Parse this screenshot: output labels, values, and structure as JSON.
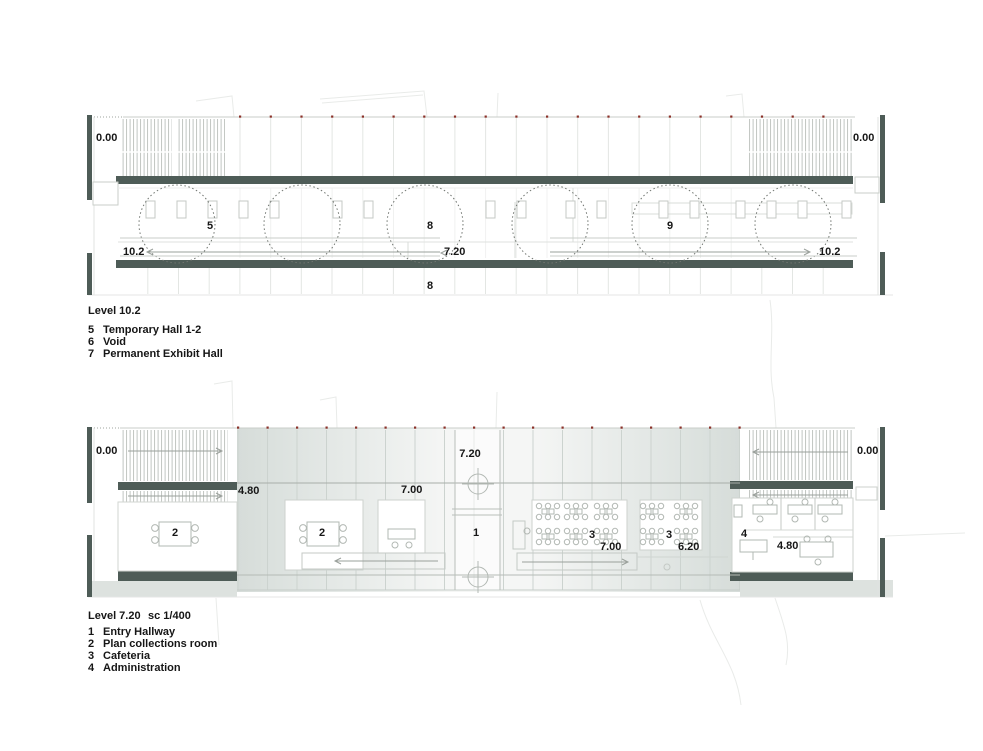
{
  "colors": {
    "wall_dark": "#4e5c57",
    "red_dot": "#8a3028",
    "hatch": "#b9beba",
    "grid_white": "#e3e6e3",
    "grid_faint": "#f0f1f0",
    "grid_tint": "#ccd3cf",
    "outline": "#c9cec9",
    "furniture": "#b2b8b3",
    "dash_circle": "#6f746f",
    "site_line": "#e9ebe9",
    "tint_edge": "#d6dcd9",
    "tint_center": "#f5f6f5",
    "arrow": "#9aa09b",
    "text": "#161616"
  },
  "upper_plan": {
    "elev_site_left": "0.00",
    "elev_site_right": "0.00",
    "room_temporary": "5",
    "room_exhibit_mid": "8",
    "room_exhibit_right": "9",
    "elev_hall_left": "10.2",
    "elev_hall_mid": "7.20",
    "elev_hall_right": "10.2",
    "label_below_hall": "8",
    "legend": {
      "title": "Level 10.2",
      "items": [
        {
          "num": "5",
          "name": "Temporary Hall 1-2"
        },
        {
          "num": "6",
          "name": "Void"
        },
        {
          "num": "7",
          "name": "Permanent Exhibit Hall"
        }
      ]
    }
  },
  "lower_plan": {
    "elev_site_left": "0.00",
    "elev_site_right": "0.00",
    "elev_entry": "7.20",
    "elev_left_stair": "4.80",
    "elev_plan_room": "7.00",
    "elev_cafeteria": "7.00",
    "elev_cafeteria2": "6.20",
    "elev_admin": "4.80",
    "room_entry": "1",
    "room_plan_left": "2",
    "room_plan_mid": "2",
    "room_cafeteria_1": "3",
    "room_cafeteria_2": "3",
    "room_admin": "4",
    "legend": {
      "title": "Level 7.20",
      "scale": "sc 1/400",
      "items": [
        {
          "num": "1",
          "name": "Entry Hallway"
        },
        {
          "num": "2",
          "name": "Plan collections room"
        },
        {
          "num": "3",
          "name": "Cafeteria"
        },
        {
          "num": "4",
          "name": "Administration"
        }
      ]
    }
  }
}
